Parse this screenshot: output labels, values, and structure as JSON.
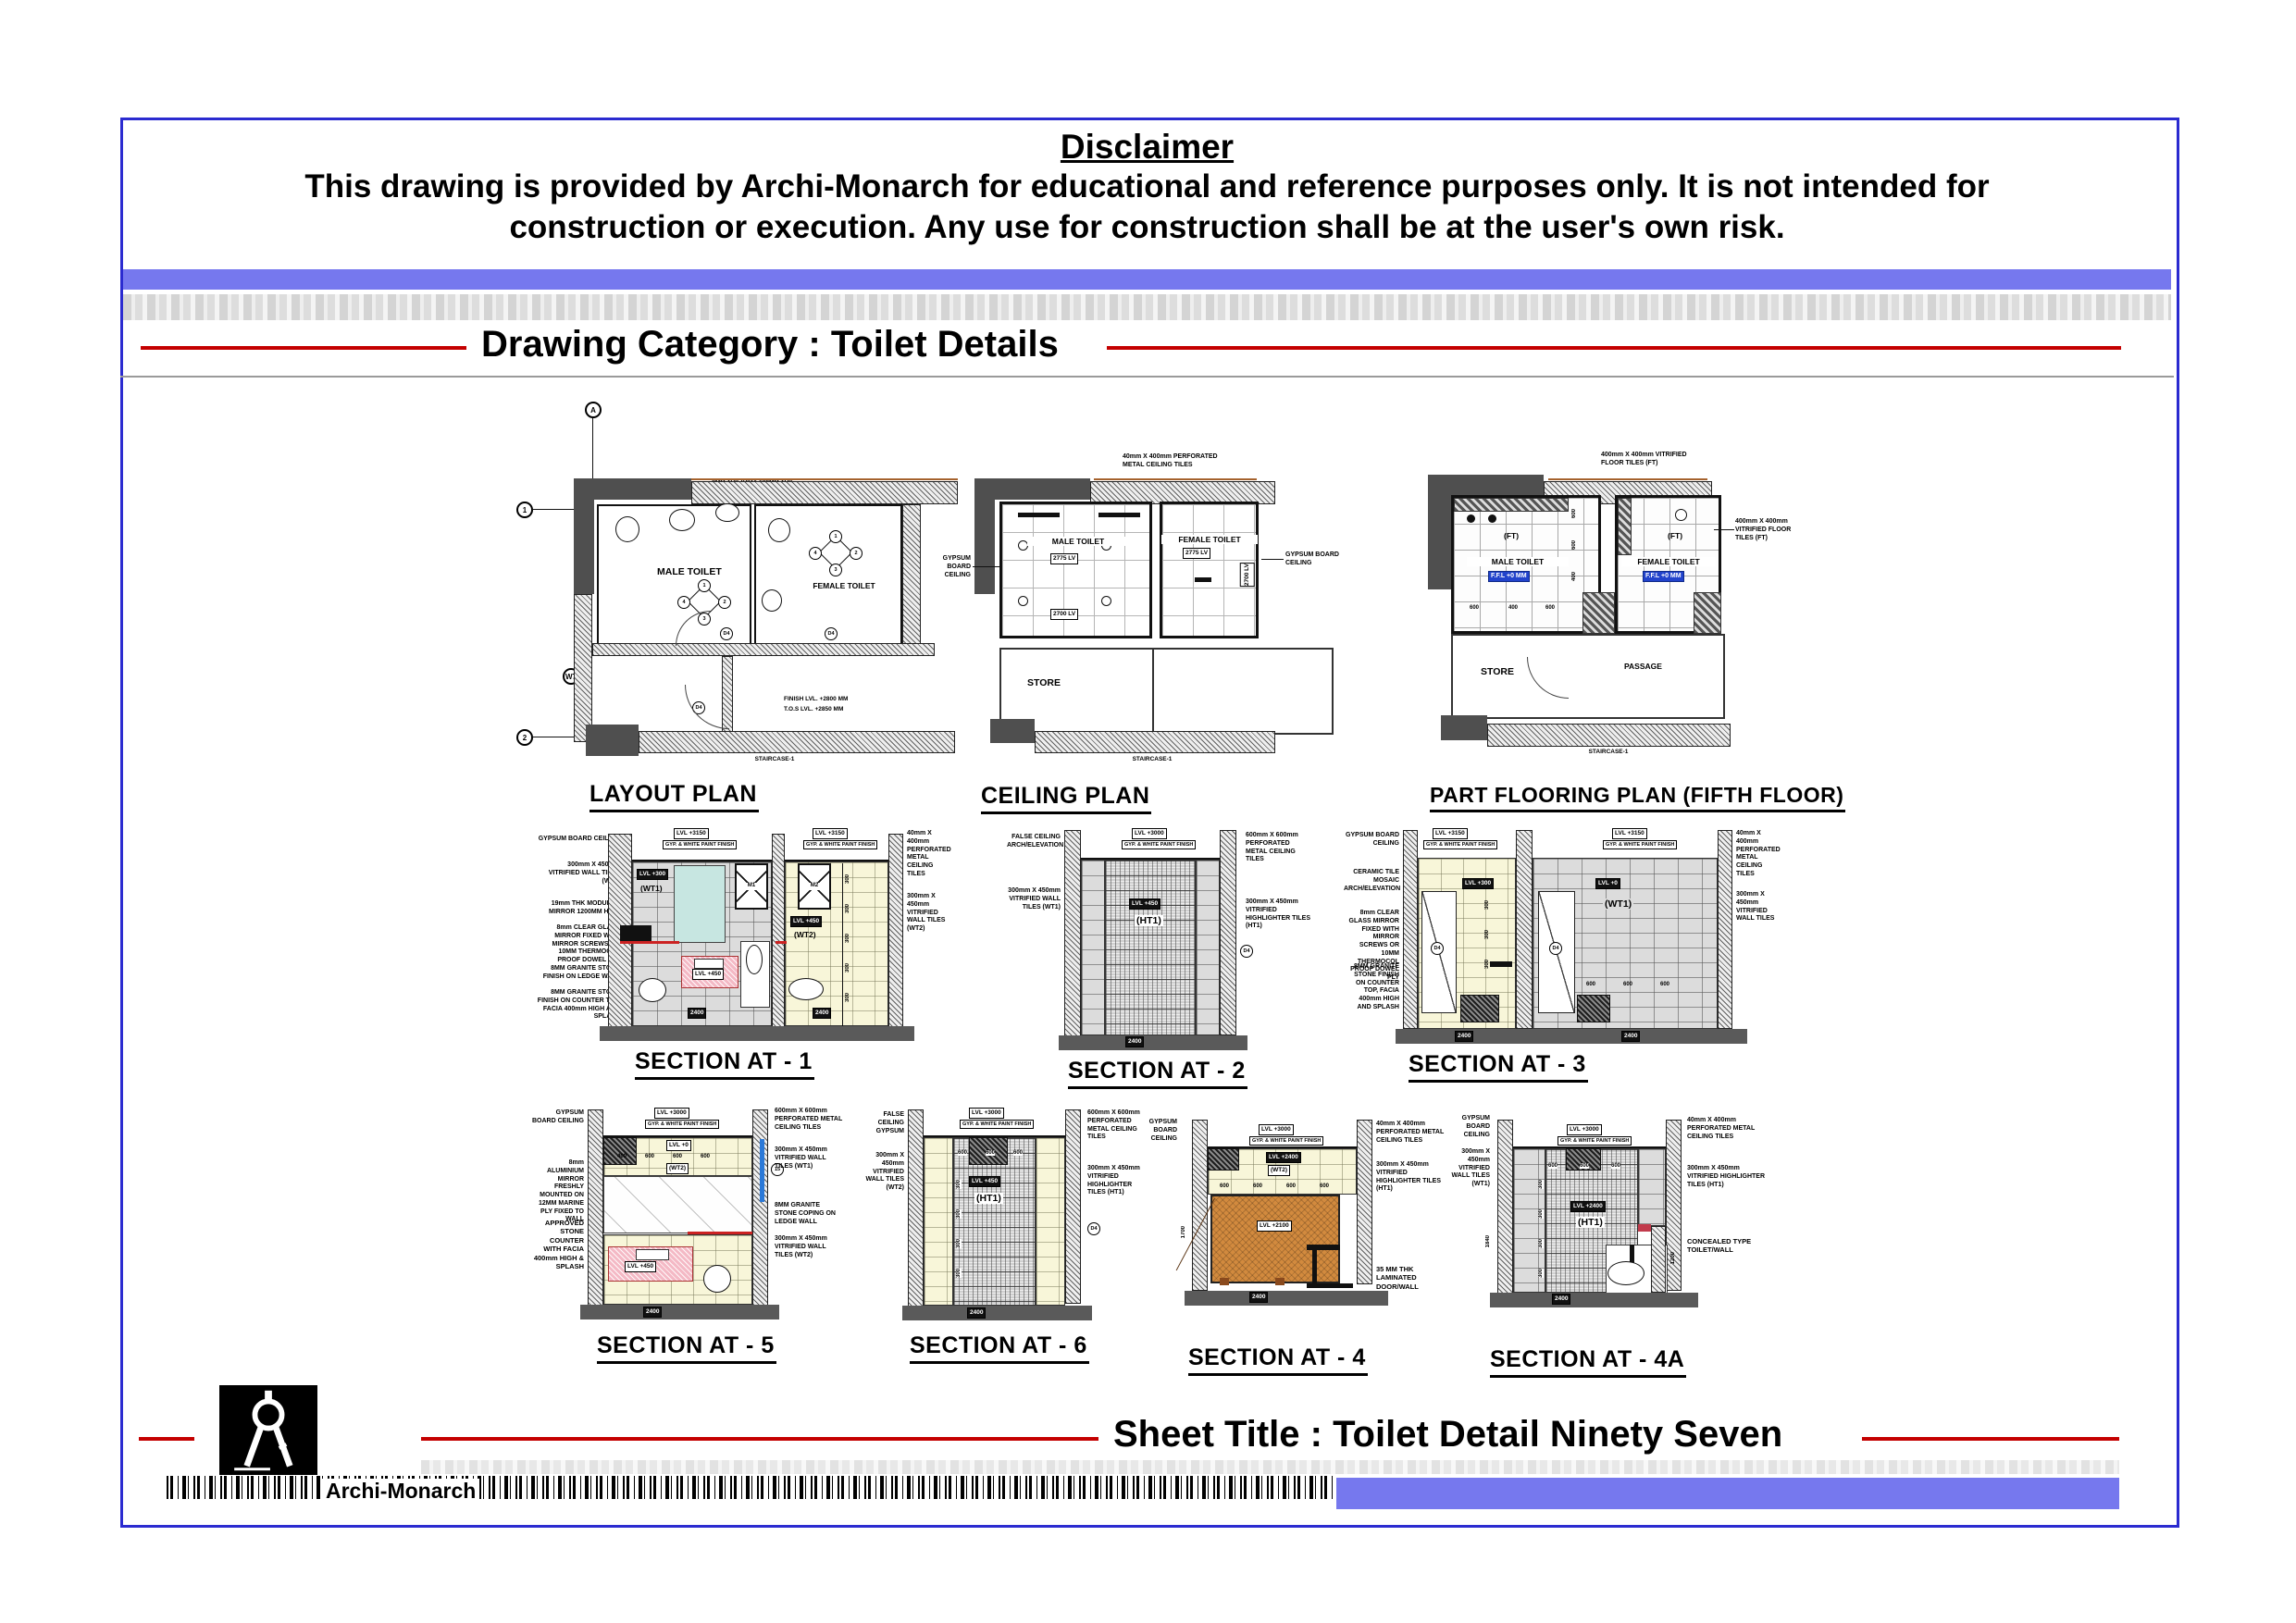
{
  "header": {
    "disclaimer_title": "Disclaimer",
    "disclaimer_line1": "This drawing is provided by Archi-Monarch for educational and reference purposes only. It is not intended for",
    "disclaimer_line2": "construction or execution. Any use for construction shall be at the user's own risk.",
    "category": "Drawing Category : Toilet Details"
  },
  "footer": {
    "sheet_title": "Sheet Title : Toilet Detail Ninety Seven",
    "brand": "Archi-Monarch"
  },
  "common": {
    "male": "MALE TOILET",
    "female": "FEMALE TOILET",
    "store": "STORE",
    "passage": "PASSAGE",
    "gypsum": "GYPSUM BOARD CEILING",
    "paint": "GYP. & WHITE PAINT FINISH",
    "pmct40": "40mm X 400mm PERFORATED METAL CEILING TILES",
    "pmct600": "600mm X 600mm PERFORATED METAL CEILING TILES",
    "vwt1": "300mm X 450mm VITRIFIED WALL TILES (WT1)",
    "vwt2": "300mm X 450mm VITRIFIED WALL TILES (WT2)",
    "vwt": "300mm X 450mm VITRIFIED WALL TILES",
    "vht1": "300mm X 450mm VITRIFIED HIGHLIGHTER TILES (HT1)",
    "false_ceiling": "FALSE CEILING ARCH/ELEVATION",
    "mirror_note": "8mm CLEAR GLASS MIRROR FIXED WITH MIRROR SCREWS OR 10MM THERMOCOL PROOF DOWEL PLY",
    "counter_note": "8MM GRANITE STONE FINISH ON COUNTER TOP, FACIA 400mm HIGH AND SPLASH",
    "wt1": "(WT1)",
    "wt2": "(WT2)",
    "ht1": "(HT1)",
    "ft": "(FT)",
    "lvl3150": "LVL +3150",
    "lvl3000": "LVL +3000",
    "lvl2400": "LVL +2400",
    "lvl2100": "LVL +2100",
    "lvl450": "LVL +450",
    "lvl300": "LVL +300",
    "lvl0": "LVL +0",
    "staircase": "STAIRCASE-1",
    "d4": "D4"
  },
  "dims": {
    "d600": "600",
    "d400": "400",
    "d300": "300",
    "d2400": "2400",
    "d1840": "1840",
    "d1700": "1700",
    "d1200": "1200"
  },
  "plans": {
    "layout": {
      "title": "LAYOUT PLAN",
      "note_left": "12MM THK KOTA 100 MM THK. LEDGE WALL",
      "note_right": "8MM THK KOTA 100MM THK. LEDGE WALL",
      "level1": "FINISH LVL. +2800 MM",
      "level2": "T.O.S LVL. +2850 MM",
      "bubble_a": "A",
      "bubble_1": "1",
      "bubble_2": "2",
      "bubble_w7": "W7",
      "c1": "1",
      "c2": "2",
      "c3": "3",
      "c4": "4"
    },
    "ceiling": {
      "title": "CEILING PLAN",
      "lv2775": "2775 LV",
      "lv2700": "2700 LV"
    },
    "flooring": {
      "title": "PART FLOORING PLAN (FIFTH FLOOR)",
      "ffl": "F.F.L +0 MM",
      "note": "400mm X 400mm VITRIFIED FLOOR TILES (FT)"
    }
  },
  "sections": {
    "s1": {
      "title": "SECTION AT - 1",
      "l3": "19mm THK MODULAR MIRROR 1200MM HIGH",
      "l5": "8MM GRANITE STONE FINISH ON LEDGE WALL",
      "fan1": "M1",
      "fan2": "M2"
    },
    "s2": {
      "title": "SECTION AT - 2"
    },
    "s3": {
      "title": "SECTION AT - 3",
      "l2": "CERAMIC TILE MOSAIC ARCH/ELEVATION"
    },
    "s5": {
      "title": "SECTION AT - 5",
      "l2": "8mm ALUMINIUM MIRROR FRESHLY MOUNTED ON 12MM MARINE PLY FIXED TO WALL",
      "l3": "APPROVED STONE COUNTER WITH FACIA 400mm HIGH & SPLASH",
      "r3": "8MM GRANITE STONE COPING ON LEDGE WALL",
      "bubble": "15"
    },
    "s6": {
      "title": "SECTION AT - 6",
      "l1": "FALSE CEILING GYPSUM"
    },
    "s4": {
      "title": "SECTION AT - 4",
      "r3": "35 MM THK LAMINATED DOOR/WALL"
    },
    "s4a": {
      "title": "SECTION AT - 4A",
      "r3": "CONCEALED TYPE TOILET/WALL"
    }
  }
}
